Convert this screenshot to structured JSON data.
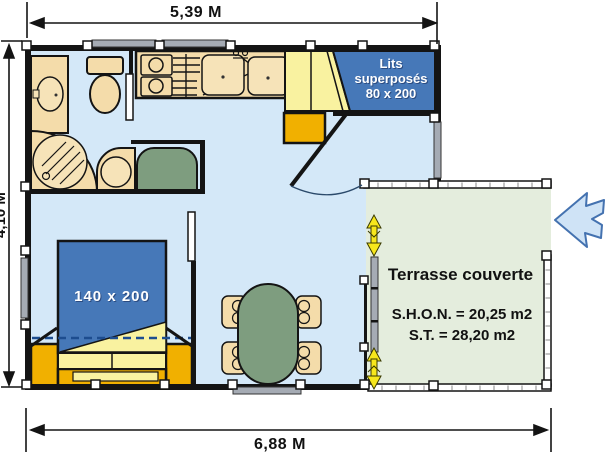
{
  "dimensions": {
    "width_top": "5,39 M",
    "width_bottom": "6,88 M",
    "depth_left": "4,10 M"
  },
  "rooms": {
    "bunk_label_lines": [
      "Lits",
      "superposés",
      "80 x 200"
    ],
    "bed_label": "140 x 200",
    "terrace": {
      "title": "Terrasse couverte",
      "shon": "S.H.O.N. = 20,25 m2",
      "st": "S.T. = 28,20 m2"
    }
  },
  "colors": {
    "floor": "#d4e8f8",
    "terrace_floor": "#e4eddd",
    "wall": "#141414",
    "fixture_beige": "#f4dcaa",
    "fixture_beige_light": "#f6e3b8",
    "bed_blue": "#4678b8",
    "gold": "#f1b000",
    "light_yellow": "#f9f2a0",
    "table_green": "#7e9d7f",
    "window_gray": "#a5abb4",
    "slide_arrow_yellow": "#f7e71c",
    "entry_arrow_fill": "#cfe3f6",
    "entry_arrow_stroke": "#4472b0"
  }
}
